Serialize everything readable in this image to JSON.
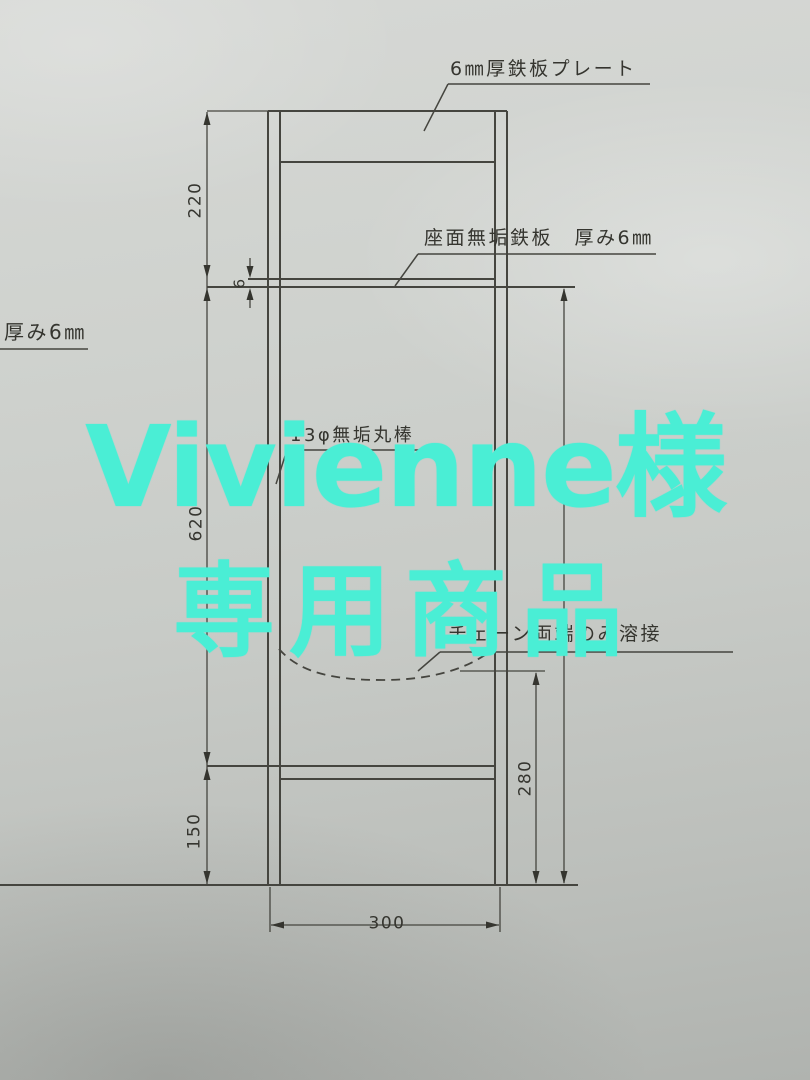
{
  "watermark": {
    "line1": "Vivienne様",
    "line2": "専用商品",
    "color": "#4aeed5"
  },
  "drawing": {
    "title_labels": {
      "top_plate": "6㎜厚鉄板プレート",
      "seat_plate": "座面無垢鉄板　厚み6㎜",
      "left_thickness": "厚み6㎜",
      "rod": "13φ無垢丸棒",
      "chain_weld": "チェーン両端のみ溶接"
    },
    "dimensions_mm": {
      "top_section_height": "220",
      "seat_plate_thickness": "6",
      "middle_section_height": "620",
      "bottom_leg_height": "150",
      "chain_to_ground": "280",
      "overall_width": "300"
    },
    "line_color": "#45453f",
    "paper_color": "#c8cbc7"
  }
}
